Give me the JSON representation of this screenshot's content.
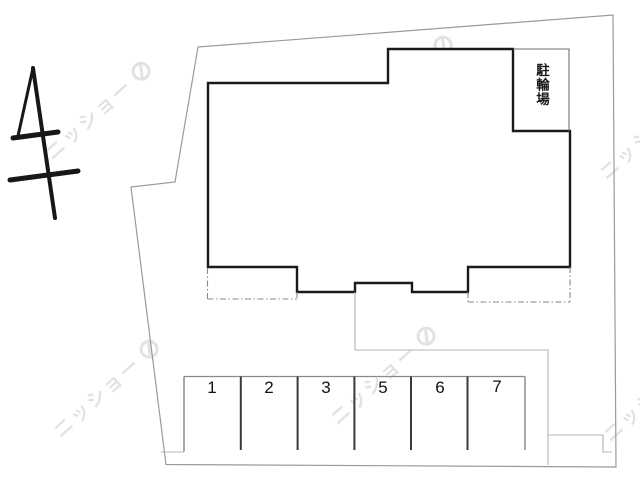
{
  "document": {
    "type": "site-plan",
    "description_visible_text_only": true
  },
  "building": {
    "bicycle_area_label": "駐輪場"
  },
  "parking": {
    "stalls": [
      {
        "number": "1"
      },
      {
        "number": "2"
      },
      {
        "number": "3"
      },
      {
        "number": "5"
      },
      {
        "number": "6"
      },
      {
        "number": "7"
      }
    ]
  },
  "watermark": {
    "text": "ニッショー"
  },
  "colors": {
    "background": "#ffffff",
    "building_outline": "#1a1a1a",
    "property_boundary": "#9a9a9a",
    "thin_lines": "#b5b5b5",
    "dashed_lines": "#8a8a8a",
    "stall_divider": "#3a3a3a",
    "watermark": "#e2e2e2",
    "text": "#111111"
  }
}
